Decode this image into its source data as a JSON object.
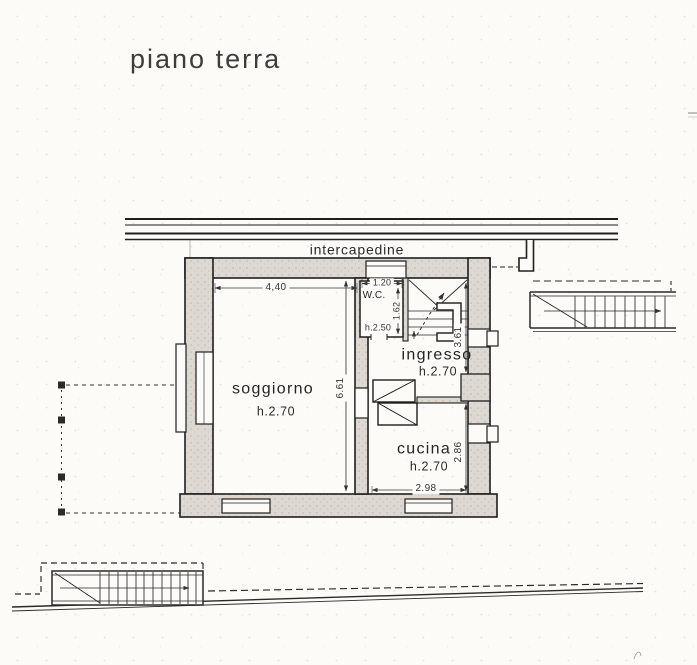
{
  "page": {
    "title": "piano terra"
  },
  "plan": {
    "zone_label": "intercapedine",
    "rooms": {
      "soggiorno": {
        "name": "soggiorno",
        "height": "h.2.70"
      },
      "ingresso": {
        "name": "ingresso",
        "height": "h.2.70"
      },
      "cucina": {
        "name": "cucina",
        "height": "h.2.70"
      },
      "wc": {
        "name": "W.C.",
        "height": "h.2.50"
      }
    },
    "dims": {
      "soggiorno_width": "4,40",
      "soggiorno_depth": "6.61",
      "wc_width": "1.20",
      "wc_depth": "1.62",
      "ingresso_depth": "3.61",
      "cucina_depth": "2.86",
      "cucina_width": "2.98"
    },
    "colors": {
      "ink": "#1f1f1f",
      "wall_fill": "#ddd9d2",
      "paper": "#fcfbf8"
    }
  }
}
